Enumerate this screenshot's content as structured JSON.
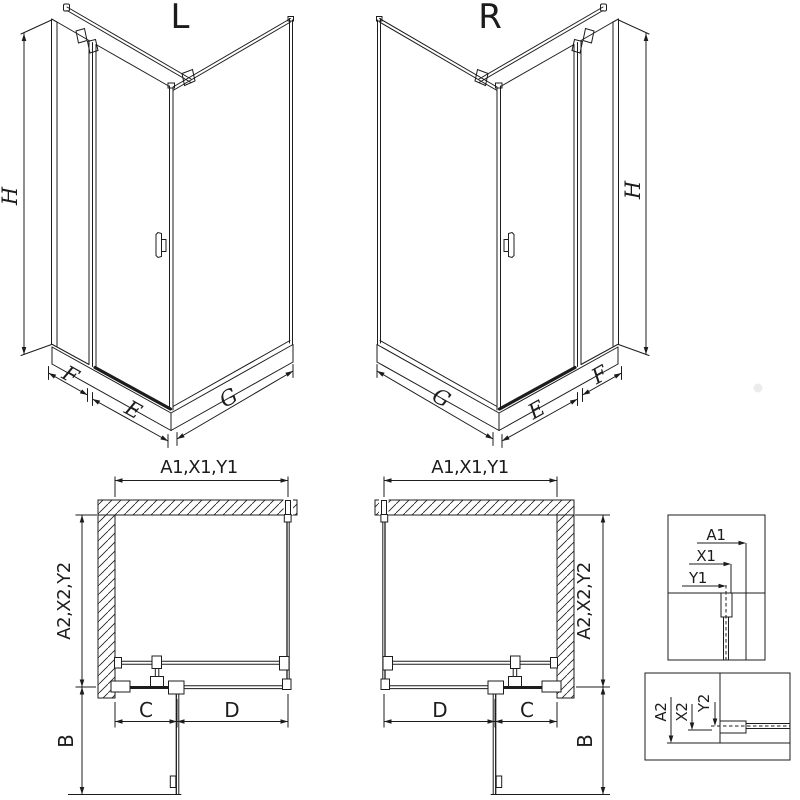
{
  "colors": {
    "line": "#1c1c1c",
    "background": "#ffffff"
  },
  "variants": [
    {
      "code": "L",
      "iso": {
        "height": "H",
        "return_panel": "F",
        "door": "E",
        "side_panel": "G"
      },
      "plan": {
        "top": "A1,X1,Y1",
        "side": "A2,X2,Y2",
        "door_zone": "C",
        "fixed_zone": "D",
        "door_swing": "B"
      }
    },
    {
      "code": "R",
      "iso": {
        "height": "H",
        "return_panel": "F",
        "door": "E",
        "side_panel": "G"
      },
      "plan": {
        "top": "A1,X1,Y1",
        "side": "A2,X2,Y2",
        "door_zone": "C",
        "fixed_zone": "D",
        "door_swing": "B"
      }
    }
  ],
  "details": [
    {
      "labels": [
        "A1",
        "X1",
        "Y1"
      ]
    },
    {
      "labels": [
        "A2",
        "X2",
        "Y2"
      ]
    }
  ]
}
